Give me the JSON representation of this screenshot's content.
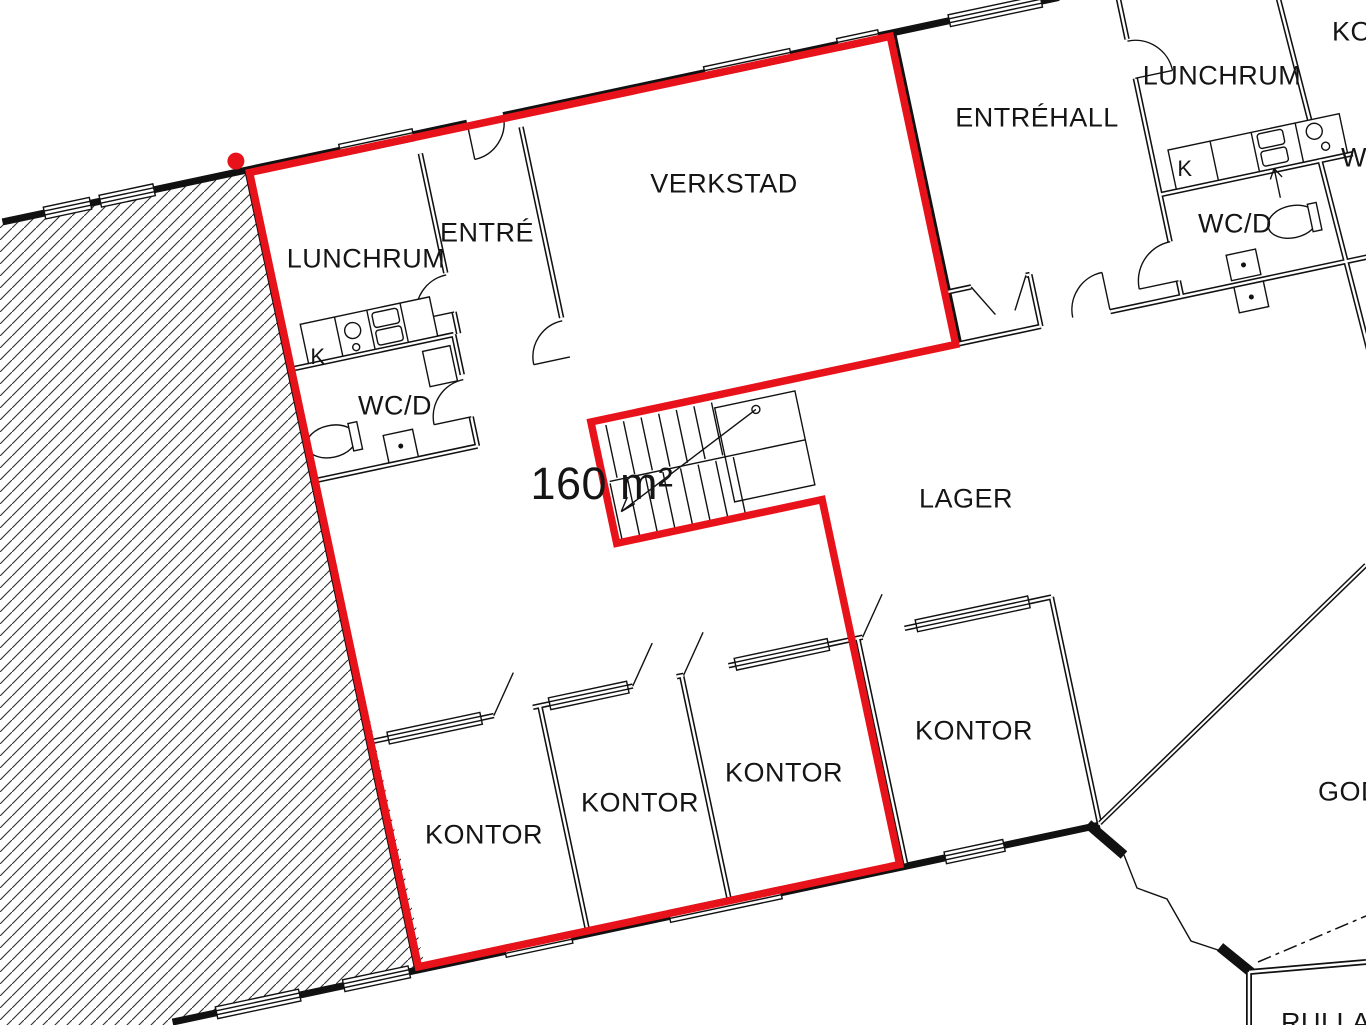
{
  "plan": {
    "type": "architectural-floor-plan",
    "highlight_color": "#e8121a",
    "wall_color": "#111111",
    "area_label": {
      "text": "160 m²",
      "x": 602,
      "y": 483,
      "size": 45
    },
    "marker": {
      "x": 236,
      "y": 160
    },
    "rooms": [
      {
        "name": "lunchrum-left",
        "label": "LUNCHRUM",
        "x": 366,
        "y": 258,
        "size": 27,
        "anchor": "middle"
      },
      {
        "name": "entre",
        "label": "ENTRÉ",
        "x": 487,
        "y": 232,
        "size": 27,
        "anchor": "middle"
      },
      {
        "name": "verkstad",
        "label": "VERKSTAD",
        "x": 724,
        "y": 183,
        "size": 27,
        "anchor": "middle"
      },
      {
        "name": "entrehall",
        "label": "ENTRÉHALL",
        "x": 1037,
        "y": 117,
        "size": 27,
        "anchor": "middle"
      },
      {
        "name": "lunchrum-right",
        "label": "LUNCHRUM",
        "x": 1222,
        "y": 75,
        "size": 27,
        "anchor": "middle"
      },
      {
        "name": "kontor-clipped",
        "label": "KO",
        "x": 1332,
        "y": 31,
        "size": 27,
        "anchor": "start"
      },
      {
        "name": "wc-clipped",
        "label": "WC",
        "x": 1341,
        "y": 157,
        "size": 27,
        "anchor": "start"
      },
      {
        "name": "kitchen-left",
        "label": "K",
        "x": 318,
        "y": 356,
        "size": 22,
        "anchor": "middle"
      },
      {
        "name": "wcd-left",
        "label": "WC/D",
        "x": 395,
        "y": 405,
        "size": 27,
        "anchor": "middle"
      },
      {
        "name": "kitchen-right",
        "label": "K",
        "x": 1185,
        "y": 168,
        "size": 22,
        "anchor": "middle"
      },
      {
        "name": "wcd-right",
        "label": "WC/D",
        "x": 1235,
        "y": 223,
        "size": 27,
        "anchor": "middle"
      },
      {
        "name": "lager",
        "label": "LAGER",
        "x": 966,
        "y": 498,
        "size": 27,
        "anchor": "middle"
      },
      {
        "name": "kontor-1",
        "label": "KONTOR",
        "x": 484,
        "y": 834,
        "size": 27,
        "anchor": "middle"
      },
      {
        "name": "kontor-2",
        "label": "KONTOR",
        "x": 640,
        "y": 802,
        "size": 27,
        "anchor": "middle"
      },
      {
        "name": "kontor-3",
        "label": "KONTOR",
        "x": 784,
        "y": 772,
        "size": 27,
        "anchor": "middle"
      },
      {
        "name": "kontor-4",
        "label": "KONTOR",
        "x": 974,
        "y": 730,
        "size": 27,
        "anchor": "middle"
      },
      {
        "name": "gods-clipped",
        "label": "GODS",
        "x": 1318,
        "y": 791,
        "size": 27,
        "anchor": "start"
      },
      {
        "name": "rulla-clipped",
        "label": "RULLA",
        "x": 1281,
        "y": 1022,
        "size": 27,
        "anchor": "start"
      }
    ]
  }
}
